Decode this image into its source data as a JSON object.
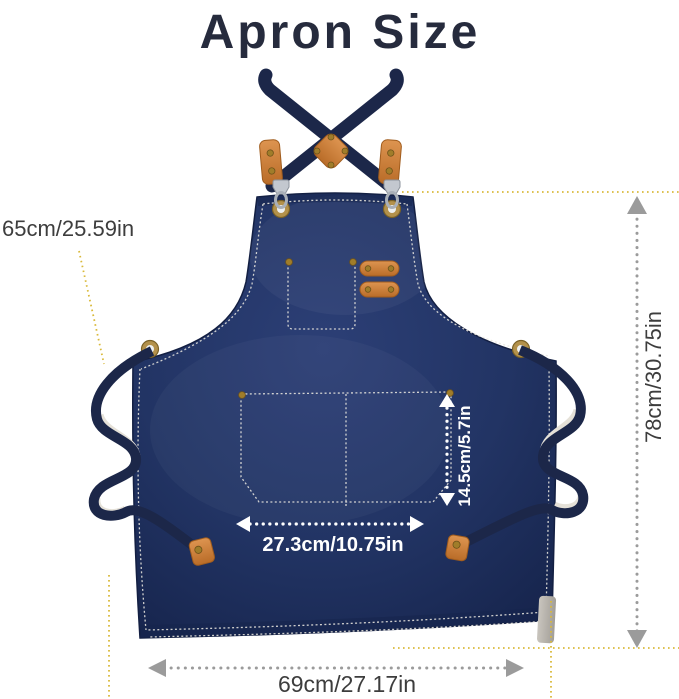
{
  "page": {
    "title": "Apron Size"
  },
  "annotations": {
    "strap": {
      "label": "65cm/25.59in"
    },
    "height": {
      "label": "78cm/30.75in"
    },
    "pocket_depth": {
      "label": "14.5cm/5.7in"
    },
    "pocket_width": {
      "label": "27.3cm/10.75in"
    },
    "bottom_width": {
      "label": "69cm/27.17in"
    }
  },
  "colors": {
    "title_text": "#262b3d",
    "annotation_text": "#3d3d3d",
    "measure_gray": "#9b9b9b",
    "guide_yellow": "#d9b93a",
    "apron_navy_light": "#2c3f76",
    "apron_navy": "#223464",
    "apron_navy_dark": "#16244c",
    "apron_outline": "#131f42",
    "strap_navy": "#1c2749",
    "leather_light": "#dd9450",
    "leather_deep": "#b96c28",
    "leather_outline": "#a05c1d",
    "brass": "#a07d2a",
    "stitch_white": "#e9e7df",
    "strap_underside": "#e5e1d8",
    "metal_gray": "#c3c8cf",
    "pocket_label": "#ffffff"
  }
}
